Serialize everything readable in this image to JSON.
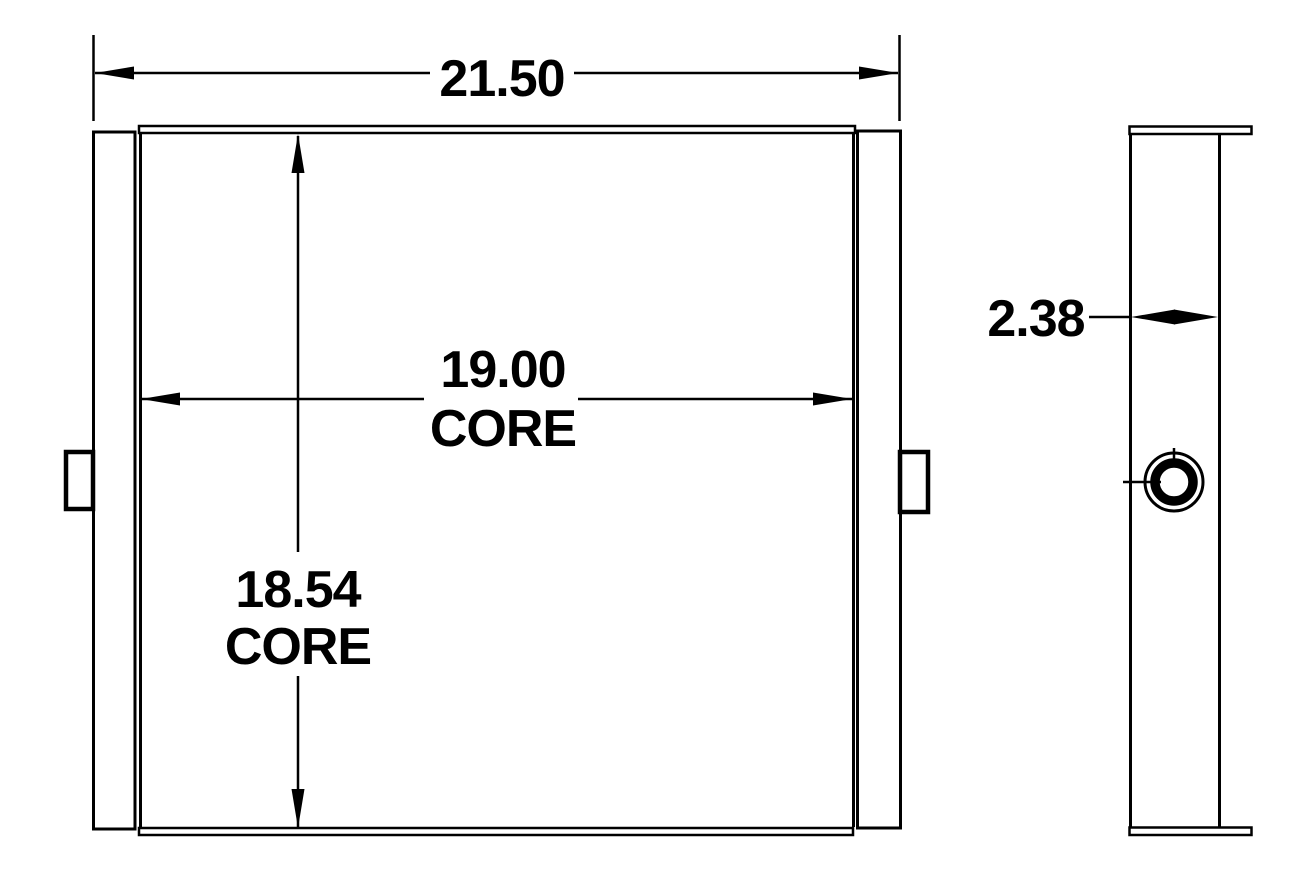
{
  "drawing": {
    "line_color": "#000000",
    "background_color": "#ffffff",
    "dimensions": {
      "overall_width": {
        "value": "21.50"
      },
      "core_width": {
        "value": "19.00",
        "qualifier": "CORE"
      },
      "core_height": {
        "value": "18.54",
        "qualifier": "CORE"
      },
      "depth": {
        "value": "2.38"
      }
    }
  }
}
